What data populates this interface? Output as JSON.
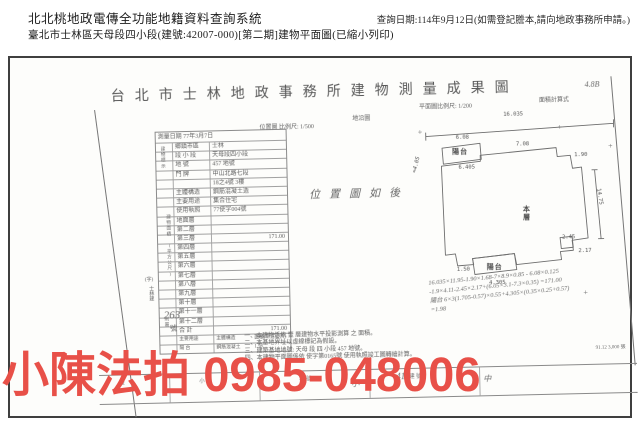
{
  "header": {
    "system_title": "北北桃地政電傳全功能地籍資料查詢系統",
    "query_date": "查詢日期:114年9月12日(如需登記謄本,請向地政事務所申請。)",
    "subject_line": "臺北市士林區天母段四小段(建號:42007-000)[第二期]建物平面圖(已縮小列印)"
  },
  "scan": {
    "title": "台北市士林地政事務所建物測量成果圖",
    "corner_note": "4.8B",
    "meta_row": {
      "survey_date": "測量日期 77年3月7日",
      "location_scale": "位置圖 比例尺: 1/500",
      "sheet_note": "地沿圖",
      "plan_scale": "平面圖比例尺: 1/200",
      "area_calc_label": "面積計算式"
    },
    "info_table": {
      "group_label_1": "建物標示",
      "group_label_2": "建物面積 (平方公尺)",
      "group_label_3": "附屬",
      "rows": [
        {
          "label": "鄉鎮市區",
          "value": "士林"
        },
        {
          "label": "段 小 段",
          "value": "天母段四小段"
        },
        {
          "label": "地  號",
          "value": "457 地號"
        },
        {
          "label": "門  牌",
          "value": "中山北路七段"
        },
        {
          "label": "",
          "value": "18之4號 3樓"
        },
        {
          "label": "主體構造",
          "value": "鋼筋混凝土造"
        },
        {
          "label": "主要用途",
          "value": "集合住宅"
        },
        {
          "label": "使用執照",
          "value": "77使字004號"
        }
      ],
      "floor_rows": [
        {
          "label": "地面層",
          "value": ""
        },
        {
          "label": "第二層",
          "value": ""
        },
        {
          "label": "第三層",
          "value": "171.00"
        },
        {
          "label": "第四層",
          "value": ""
        },
        {
          "label": "第五層",
          "value": ""
        },
        {
          "label": "第六層",
          "value": ""
        },
        {
          "label": "第七層",
          "value": ""
        },
        {
          "label": "第八層",
          "value": ""
        },
        {
          "label": "第九層",
          "value": ""
        },
        {
          "label": "第十層",
          "value": ""
        },
        {
          "label": "第十一層",
          "value": ""
        },
        {
          "label": "第十二層",
          "value": ""
        },
        {
          "label": "合 計",
          "value": "171.00"
        }
      ],
      "annex_header": {
        "use": "主要用途",
        "structure": "主體構造",
        "area": "面積(平方公尺)"
      },
      "annex_row": {
        "use": "陽 台",
        "structure": "鋼筋混凝土",
        "area": "1.98"
      }
    },
    "receipt": {
      "prefix": "(字)",
      "office": "士林建",
      "number": "263",
      "suffix": "號"
    },
    "location_note": "位置圖如後",
    "plan": {
      "balcony_top": "陽台",
      "balcony_bottom": "陽台",
      "center_label": "本層",
      "dim_top": "16.035",
      "dim_balcony_top": "6.08",
      "dim_balcony_top_inner": "6.405",
      "dim_top_mid": "7.08",
      "dim_top_right": "1.90",
      "dim_right": "14.75",
      "dim_notch_a": "2.45",
      "dim_notch_b": "2.17",
      "dim_bottom_left": "1.50",
      "dim_balcony_bottom": "4.305",
      "hand_left_note": "=4.05",
      "registration_mark": "+"
    },
    "calc": {
      "line1": "16.035×11.95-1.90×1.68-7×8.9×0.85 - 6.08×0.125",
      "line2": "-1.9×4.11-2.45×2.17+(6.05×3.1-7.3×0.35) =171.00",
      "line3": "陽台  6×3(1.705-0.57)×0.55+4.305×(0.35×0.25+0.57)",
      "line4": "=1.98"
    },
    "notes": [
      "一、本建物係依 壹 層建物水平投影測算 之 面積。",
      "二、本基地界址以虛線標記為假設。",
      "三、建築基地地號: 天母 段 四 小段 457 地號。",
      "四、本建物平面圖係依 使字第0165號 使用執照竣工圖轉繪計算。"
    ],
    "print_code": "91.12 3,000 張",
    "bottom_strip": {
      "labels": [
        "段",
        "小 段",
        "地 號",
        "建 號"
      ],
      "hand1": "417",
      "hand2": "小",
      "hand3": "中"
    }
  },
  "watermark": {
    "text": "小陳法拍 0985-048006",
    "color": "#e85048"
  }
}
